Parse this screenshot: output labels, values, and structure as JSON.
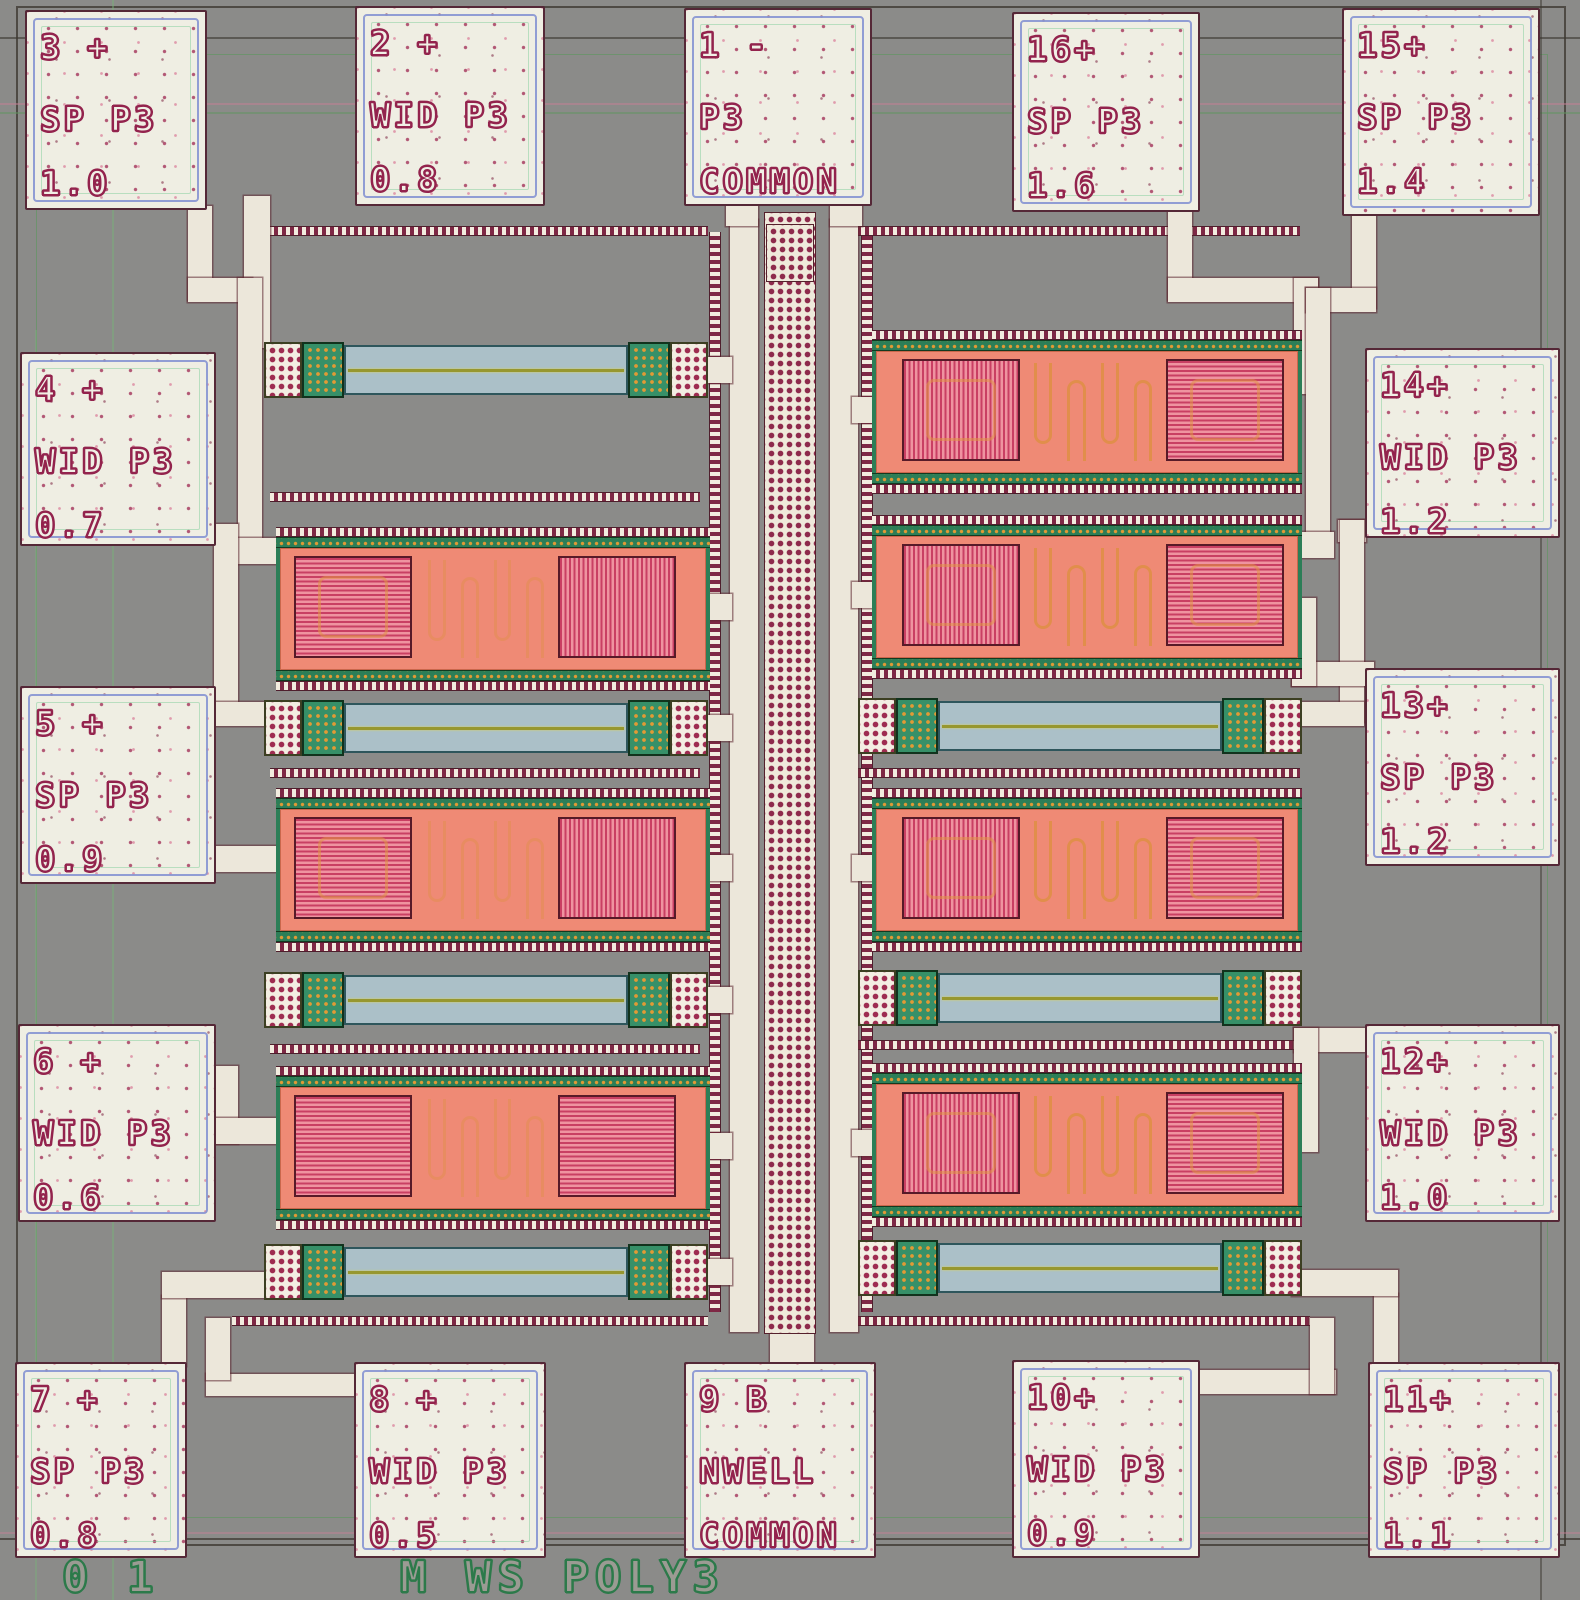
{
  "meta": {
    "description": "Microscope photograph of a silicon test die with 16 probe pads, poly3 width/space test structures",
    "bottom_scale_label": "0 1",
    "bottom_process_label": "M WS POLY3"
  },
  "pads": {
    "p1": {
      "l1": "1 -",
      "l2": "P3",
      "l3": "COMMON"
    },
    "p2": {
      "l1": "2 +",
      "l2": "WID P3",
      "l3": "0.8"
    },
    "p3": {
      "l1": "3 +",
      "l2": "SP P3",
      "l3": "1.0"
    },
    "p4": {
      "l1": "4 +",
      "l2": "WID P3",
      "l3": "0.7"
    },
    "p5": {
      "l1": "5 +",
      "l2": "SP P3",
      "l3": "0.9"
    },
    "p6": {
      "l1": "6 +",
      "l2": "WID P3",
      "l3": "0.6"
    },
    "p7": {
      "l1": "7 +",
      "l2": "SP P3",
      "l3": "0.8"
    },
    "p8": {
      "l1": "8 +",
      "l2": "WID P3",
      "l3": "0.5"
    },
    "p9": {
      "l1": "9 B",
      "l2": "NWELL",
      "l3": "COMMON"
    },
    "p10": {
      "l1": "10+",
      "l2": "WID P3",
      "l3": "0.9"
    },
    "p11": {
      "l1": "11+",
      "l2": "SP P3",
      "l3": "1.1"
    },
    "p12": {
      "l1": "12+",
      "l2": "WID P3",
      "l3": "1.0"
    },
    "p13": {
      "l1": "13+",
      "l2": "SP P3",
      "l3": "1.2"
    },
    "p14": {
      "l1": "14+",
      "l2": "WID P3",
      "l3": "1.2"
    },
    "p15": {
      "l1": "15+",
      "l2": "SP P3",
      "l3": "1.4"
    },
    "p16": {
      "l1": "16+",
      "l2": "SP P3",
      "l3": "1.6"
    }
  },
  "labels": {
    "scale": "0 1",
    "process": "M WS POLY3"
  },
  "structures": {
    "left_column": {
      "serpentine_blocks": 3,
      "kelvin_bars": 4
    },
    "right_column": {
      "serpentine_blocks": 4,
      "kelvin_bars": 3
    },
    "center": "common via strip connecting pad 1 (P3 COMMON) to pad 9 (NWELL COMMON)"
  },
  "colors": {
    "background": "#8b8b89",
    "pad_fill": "#efeee3",
    "pad_text_outline": "#93234d",
    "pad_inner_ring": "#8694d2",
    "metal_trace": "#ece7da",
    "serpentine_fill": "#ef8a75",
    "stripe_dark": "#c93f63",
    "stripe_light": "#ef93a0",
    "contact_green": "#369068",
    "contact_dot_orange": "#e09a35",
    "via_dot_maroon": "#8e2a4c",
    "bar_fill": "#abc0c8",
    "poly_line_olive": "#97972f",
    "etch_label_green": "#2c7a4a"
  }
}
